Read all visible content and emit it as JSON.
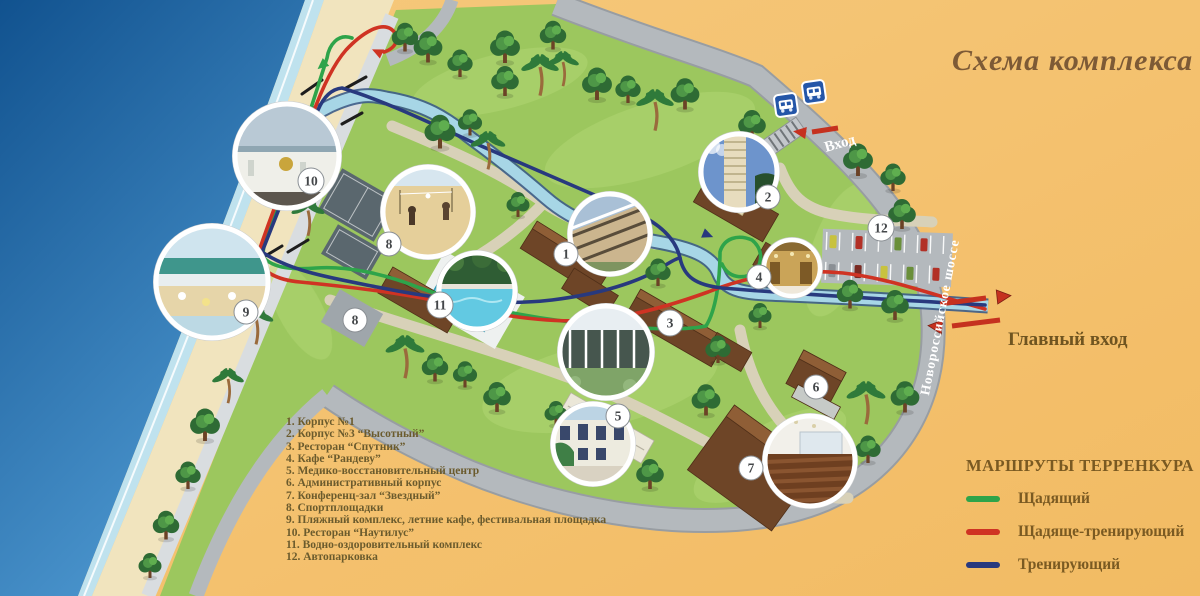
{
  "title": "Схема комплекса",
  "legend": {
    "items": [
      "1. Корпус №1",
      "2. Корпус №3 “Высотный”",
      "3. Ресторан “Спутник”",
      "4. Кафе “Рандеву”",
      "5. Медико-восстановительный центр",
      "6. Административный корпус",
      "7. Конференц-зал “Звездный”",
      "8. Спортплощадки",
      "9. Пляжный комплекс, летние кафе, фестивальная площадка",
      "10. Ресторан “Наутилус”",
      "11. Водно-оздоровительный комплекс",
      "12. Автопарковка"
    ]
  },
  "routes_legend": {
    "title": "МАРШРУТЫ ТЕРРЕНКУРА",
    "items": [
      {
        "label": "Щадящий",
        "color": "#2ea44a"
      },
      {
        "label": "Щадяще-тренирующий",
        "color": "#cf3323"
      },
      {
        "label": "Тренирующий",
        "color": "#28397e"
      }
    ]
  },
  "map": {
    "labels": {
      "entrance": "Вход",
      "main_entrance": "Главный вход",
      "highway": "Новороссийское шоссе"
    },
    "badge_numbers": [
      "1",
      "2",
      "3",
      "4",
      "5",
      "6",
      "7",
      "8",
      "8",
      "9",
      "10",
      "11",
      "12"
    ],
    "icons": [
      "bus-stop-icon",
      "stairs-icon",
      "entrance-arrow-icon",
      "main-entrance-arrow-right-icon",
      "main-entrance-arrow-left-icon",
      "tree-icon",
      "palm-icon",
      "bridge-icon"
    ],
    "colors": {
      "background": "#f4c172",
      "sea": "#1a5fa8",
      "sand": "#f1e4be",
      "park": "#9cc75e",
      "road": "#b4b9bd",
      "canal": "#a7d6e6",
      "route_green": "#2ea44a",
      "route_red": "#cf3323",
      "route_blue": "#28397e"
    }
  }
}
